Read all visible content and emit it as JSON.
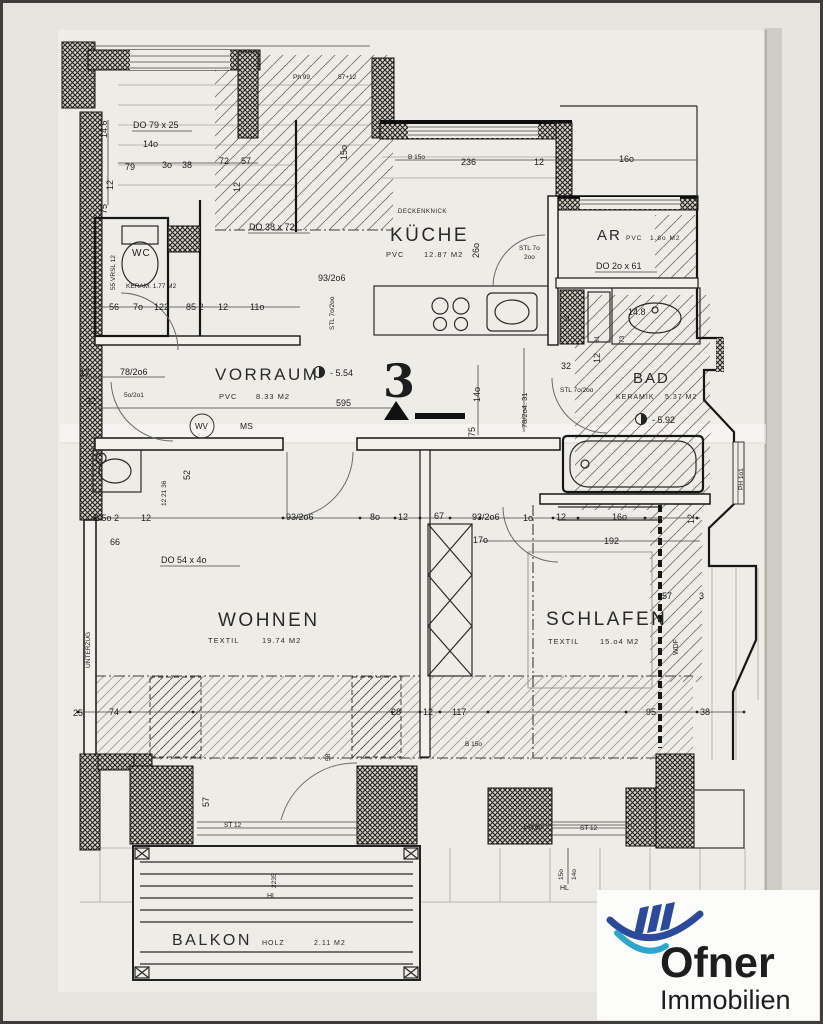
{
  "rooms": {
    "vorraum": {
      "name": "VORRAUM",
      "floor": "PVC",
      "area": "8.33 M2"
    },
    "kueche": {
      "name": "KÜCHE",
      "floor": "PVC",
      "area": "12.87 M2"
    },
    "ar": {
      "name": "AR",
      "floor": "PVC",
      "area": "1.8o M2"
    },
    "bad": {
      "name": "BAD",
      "floor": "KERAMIK",
      "area": "5.37 M2"
    },
    "wc": {
      "name": "WC",
      "note": "KERAM. 1.77 M2"
    },
    "wohnen": {
      "name": "WOHNEN",
      "floor": "TEXTIL",
      "area": "19.74 M2"
    },
    "schlafen": {
      "name": "SCHLAFEN",
      "floor": "TEXTIL",
      "area": "15.o4 M2"
    },
    "balkon": {
      "name": "BALKON",
      "floor": "HOLZ",
      "area": "2.11 M2"
    }
  },
  "unit": {
    "number": "3"
  },
  "levels": {
    "vorraum": "- 5.54",
    "bad": "- 5.92"
  },
  "doors": {
    "d1": "DO 79 x 25",
    "d2": "DO 38 x 72",
    "d3": "DO 2o x 61",
    "d4": "DO 54 x 4o"
  },
  "annotations": {
    "deckenknick": "DECKENKNICK",
    "wv": "WV",
    "ms": "MS",
    "wdf": "WDF",
    "unterzug": "UNTERZUG",
    "hl1": "HL",
    "hl2": "HL"
  },
  "dims": [
    "Ph 99",
    "57+12",
    "14.6",
    "14o",
    "79",
    "3o",
    "38",
    "72",
    "57",
    "12",
    "12",
    "15o",
    "B 15o",
    "236",
    "12",
    "16o",
    "26o",
    "STL 7o",
    "2oo",
    "93/2o6",
    "STL 7o/2oo",
    "75",
    "55 VRSL 12",
    "56",
    "7o",
    "122",
    "85 2",
    "12",
    "11o",
    "17",
    "78/2o6",
    "32",
    "5o/2o1",
    "595",
    "14o",
    "78/2o4. 31",
    "75",
    "32",
    "12",
    "STL 7o/2oo",
    "61",
    "73",
    "14.8",
    "12",
    "12 21 36",
    "52",
    "2 5o 2",
    "12",
    "66",
    "93/2o6",
    "8o",
    "12",
    "67",
    "93/2o6",
    "1o",
    "12",
    "16o",
    "17o",
    "192",
    "57",
    "3",
    "12",
    "25",
    "74",
    "28",
    "12",
    "117",
    "B 15o",
    "95",
    "38",
    "57",
    "ST 12",
    "58",
    "PH 99",
    "ST 12",
    "15o",
    "14o",
    "2235",
    "PH 1o1"
  ],
  "logo": {
    "brand": "Ofner",
    "tagline": "Immobilien",
    "navy": "#2b4a9c",
    "cyan": "#2ba6cc"
  }
}
